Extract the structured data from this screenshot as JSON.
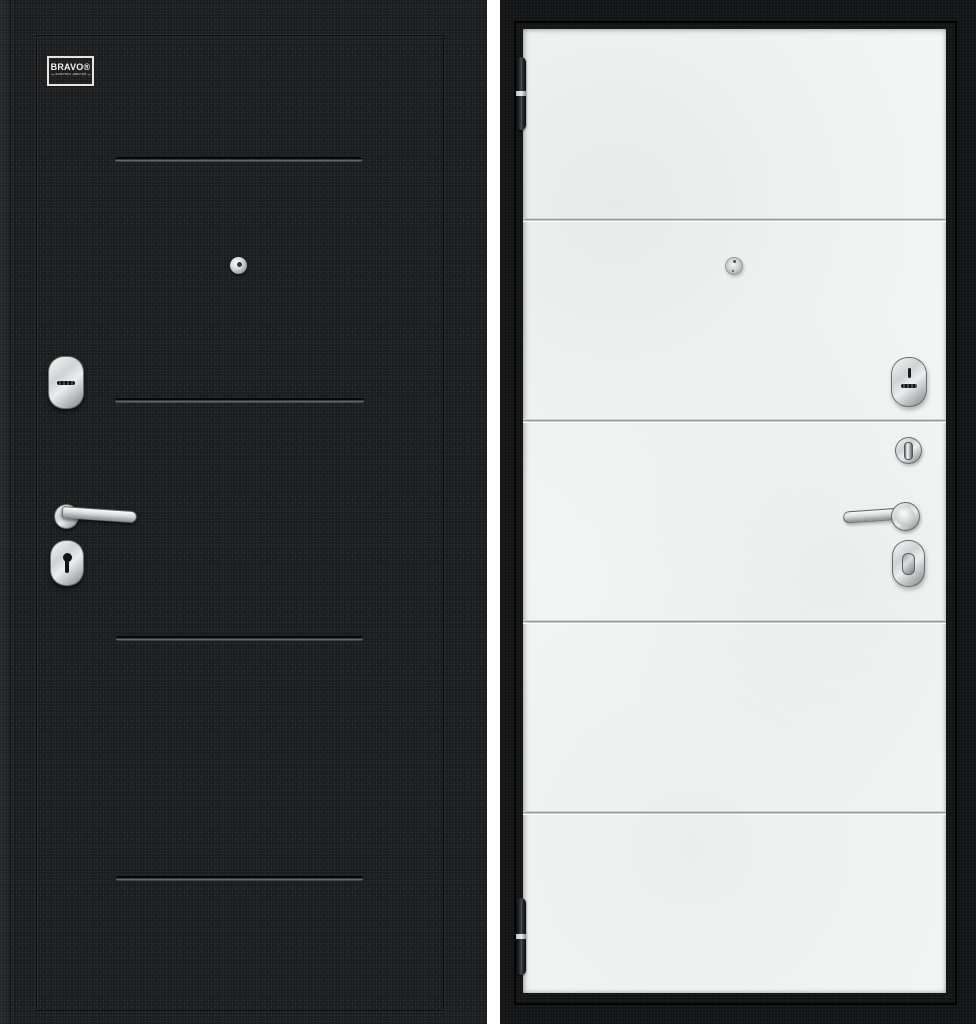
{
  "brand_plate": {
    "name": "BRAVO®",
    "tagline": "ФАБРИКА ДВЕРЕЙ"
  },
  "colors": {
    "background": "#ffffff",
    "door_black": "#1a1c1e",
    "door_frame_black": "#121416",
    "panel_white": "#f4f6f5",
    "groove_shadow": "#07080a",
    "groove_highlight": "#63676a",
    "metal_light": "#f7f8f8",
    "metal_dark": "#8d9092"
  },
  "left_door": {
    "side_label": "exterior black textured panel",
    "groove_count": 4,
    "hardware": [
      "peephole-icon",
      "lever-lock-escutcheon",
      "door-handle",
      "keyhole-escutcheon"
    ]
  },
  "right_door": {
    "side_label": "interior white panel",
    "groove_count": 4,
    "hardware": [
      "hinge-top",
      "hinge-bottom",
      "peephole-icon",
      "keyway-escutcheon",
      "thumbturn-knob",
      "door-handle",
      "cylinder-escutcheon"
    ]
  }
}
